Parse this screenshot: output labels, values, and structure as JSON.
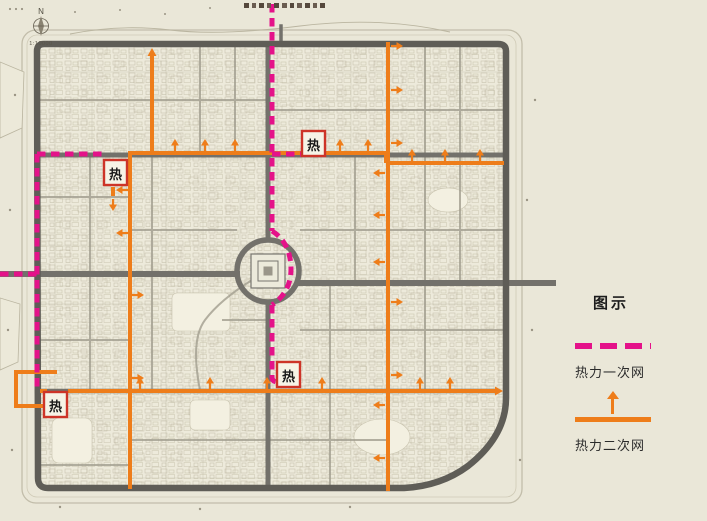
{
  "page": {
    "background": "#eae7d8",
    "width": 707,
    "height": 521
  },
  "map": {
    "north_label": "N",
    "scale_label": "1:10000",
    "plant_label": "热",
    "colors": {
      "primary_network": "#e41289",
      "secondary_network": "#ee7d1a",
      "road": "#73716b",
      "wall": "#5f5d57",
      "plant_box_border": "#cd3428",
      "background": "#eae7d8"
    }
  },
  "legend": {
    "title": "图示",
    "items": [
      {
        "label": "热力一次网",
        "style": "dashed",
        "color": "#e41289"
      },
      {
        "label": "热力二次网",
        "style": "solid-arrow",
        "color": "#ee7d1a"
      }
    ]
  }
}
